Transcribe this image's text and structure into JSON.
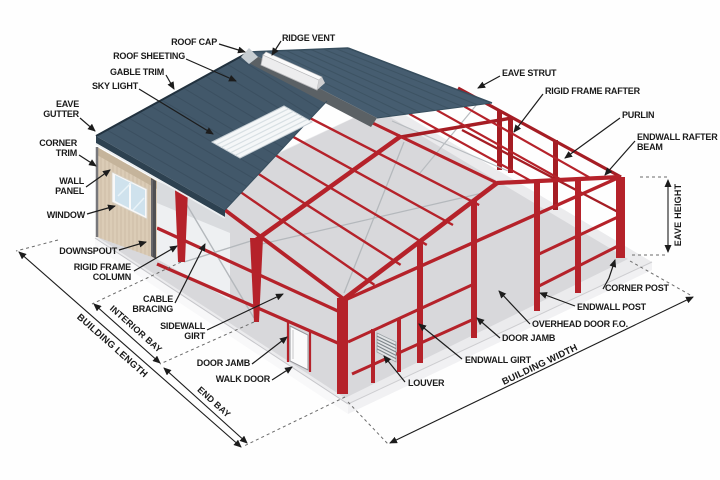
{
  "diagram": {
    "subject": "Steel building components diagram",
    "background": "#ffffff"
  },
  "colors": {
    "frame_red": "#b5222a",
    "frame_red_dark": "#a51d24",
    "roof_blue": "#42586a",
    "roof_blue_rear": "#465d70",
    "wall_tan": "#dbccb6",
    "slab_gray": "#d8d8db",
    "label_text": "#1a1a1a"
  },
  "labels": {
    "roof_cap": "ROOF CAP",
    "ridge_vent": "RIDGE VENT",
    "roof_sheeting": "ROOF SHEETING",
    "gable_trim": "GABLE TRIM",
    "sky_light": "SKY LIGHT",
    "eave_gutter": "EAVE GUTTER",
    "corner_trim": "CORNER TRIM",
    "wall_panel": "WALL PANEL",
    "window": "WINDOW",
    "downspout": "DOWNSPOUT",
    "rigid_frame_column": "RIGID FRAME COLUMN",
    "cable_bracing": "CABLE BRACING",
    "sidewall_girt": "SIDEWALL GIRT",
    "door_jamb_left": "DOOR JAMB",
    "walk_door": "WALK DOOR",
    "eave_strut": "EAVE STRUT",
    "rigid_frame_rafter": "RIGID FRAME RAFTER",
    "purlin": "PURLIN",
    "endwall_rafter_beam": "ENDWALL RAFTER BEAM",
    "corner_post": "CORNER POST",
    "endwall_post": "ENDWALL POST",
    "overhead_door_fo": "OVERHEAD DOOR F.O.",
    "door_jamb_right": "DOOR JAMB",
    "endwall_girt": "ENDWALL GIRT",
    "louver": "LOUVER"
  },
  "dimensions": {
    "building_length": "BUILDING LENGTH",
    "interior_bay": "INTERIOR BAY",
    "end_bay": "END BAY",
    "building_width": "BUILDING WIDTH",
    "eave_height": "EAVE HEIGHT"
  }
}
